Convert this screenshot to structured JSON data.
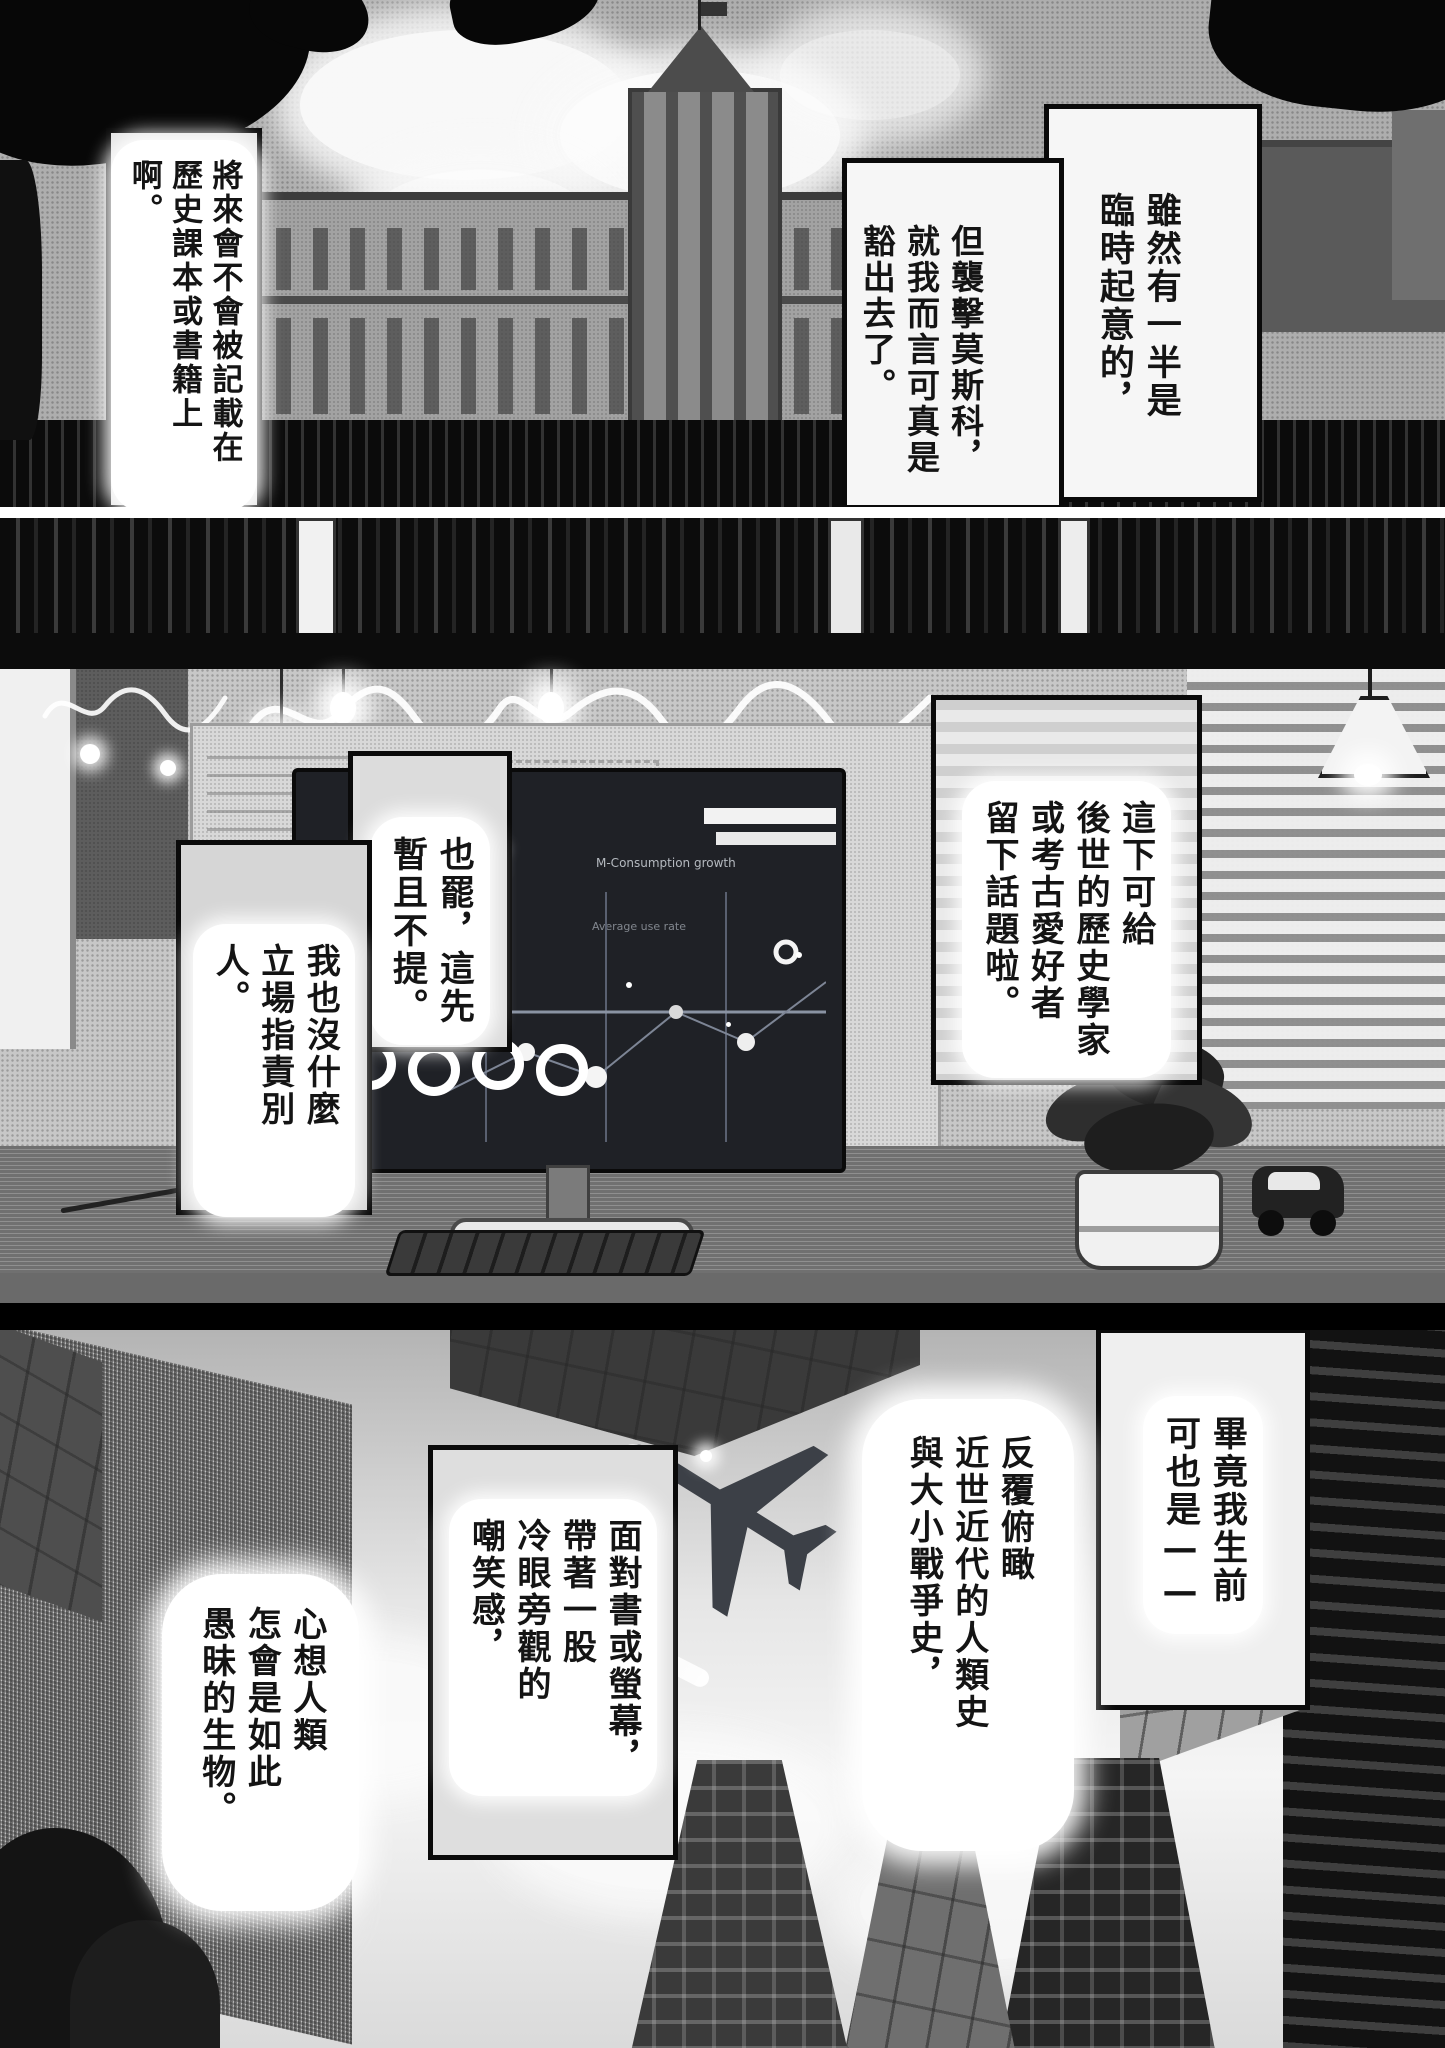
{
  "colors": {
    "ink": "#111111",
    "paper": "#ffffff",
    "halftone_gray": "#bcbcbc",
    "screen_dark": "#1f2126"
  },
  "panel1": {
    "bubble_right_top": "雖然有一半是\n臨時起意的，",
    "bubble_right_bottom": "但襲擊莫斯科，\n就我而言可真是\n豁出去了。",
    "bubble_left": "將來會不會被記載在\n歷史課本或書籍上啊。"
  },
  "panel2": {
    "bubble_right": "這下可給\n後世的歷史學家\n或考古愛好者\n留下話題啦。",
    "bubble_center": "也罷，這先\n暫且不提。",
    "bubble_left": "我也沒什麼\n立場指責別人。",
    "monitor": {
      "heading": "Analyz",
      "label_top": "M-Consumption growth",
      "label_mid": "Average use rate"
    }
  },
  "panel3": {
    "bubble_far_right": "畢竟我生前\n可也是——",
    "bubble_right": "反覆俯瞰\n近世近代的人類史\n與大小戰爭史，",
    "bubble_center": "面對書或螢幕，\n帶著一股\n冷眼旁觀的\n嘲笑感，",
    "bubble_left": "心想人類\n怎會是如此\n愚昧的生物。"
  }
}
